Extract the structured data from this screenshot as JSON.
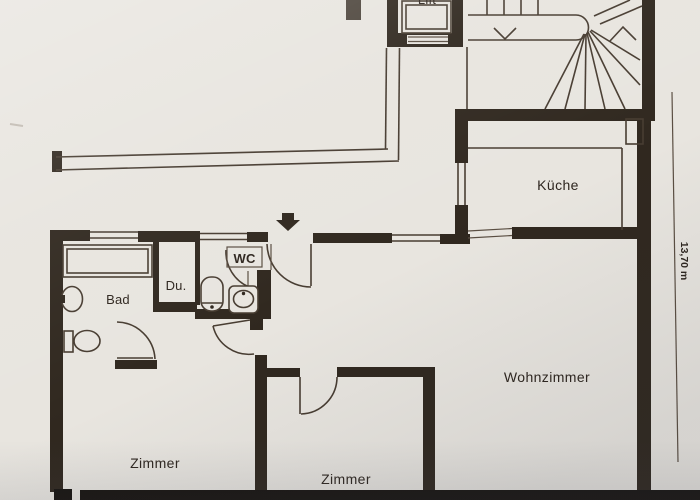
{
  "plan": {
    "title": "apartment floor plan (scanned)",
    "rooms": {
      "lift": "Lift",
      "kitchen": "Küche",
      "bathroom": "Bad",
      "shower": "Du.",
      "wc": "WC",
      "living_room": "Wohnzimmer",
      "room_left": "Zimmer",
      "room_middle": "Zimmer"
    },
    "dimension_right": "13,70 m",
    "colors": {
      "ink": "#2e261f",
      "paper": "#e8e5df",
      "bottom_band": "#181410"
    }
  }
}
